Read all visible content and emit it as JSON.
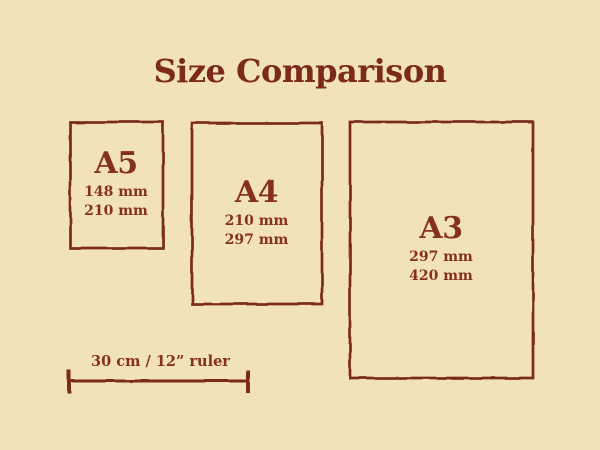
{
  "colors": {
    "background": "#F2E2B8",
    "line_ink": "#7B2A1B",
    "text_ink": "#86301F"
  },
  "title": "Size Comparison",
  "papers": [
    {
      "name": "A5",
      "dimension_1": "148 mm",
      "dimension_2": "210 mm"
    },
    {
      "name": "A4",
      "dimension_1": "210 mm",
      "dimension_2": "297 mm"
    },
    {
      "name": "A3",
      "dimension_1": "297 mm",
      "dimension_2": "420 mm"
    }
  ],
  "ruler": {
    "label": "30 cm / 12” ruler"
  }
}
